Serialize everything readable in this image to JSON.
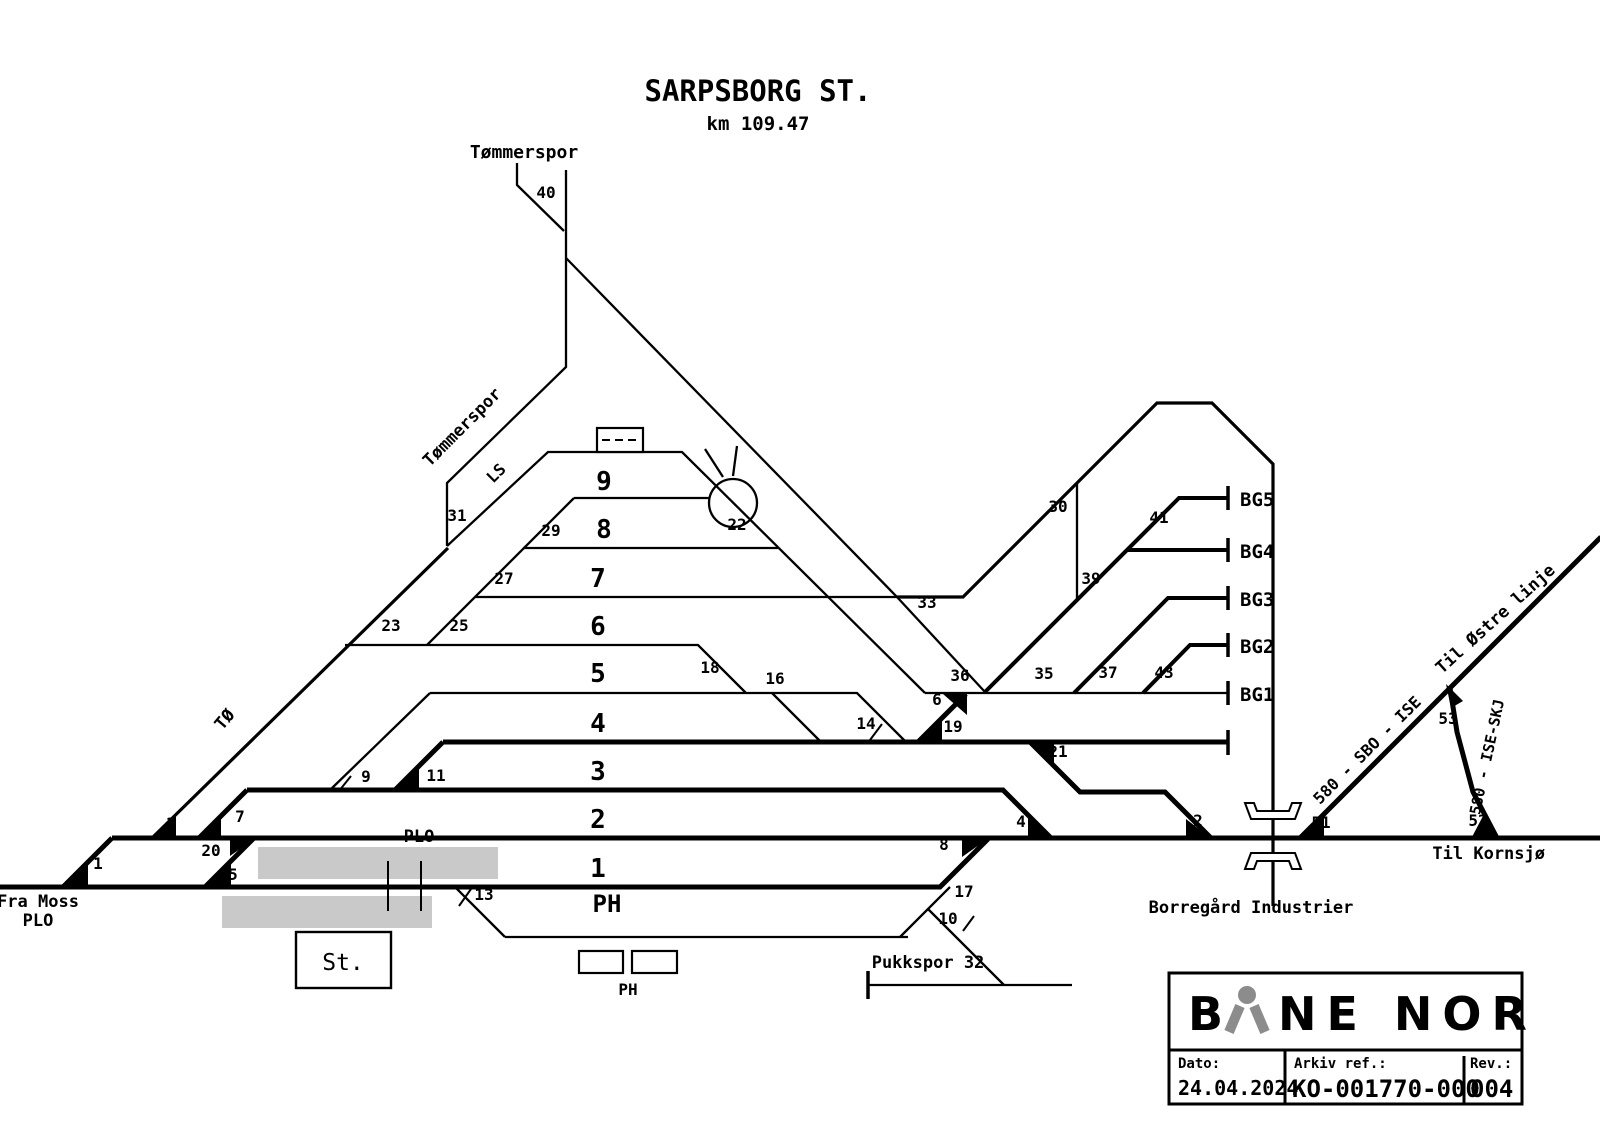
{
  "title": "SARPSBORG ST.",
  "subtitle": "km 109.47",
  "colors": {
    "line": "#000000",
    "platform": "#c9c9c9",
    "logo_gray": "#8c8c8c"
  },
  "title_block": {
    "brand_b": "B",
    "brand_rest": "NE NOR",
    "dato_label": "Dato:",
    "dato_value": "24.04.2024",
    "arkiv_label": "Arkiv ref.:",
    "arkiv_value": "KO-001770-000",
    "rev_label": "Rev.:",
    "rev_value": "004"
  },
  "labels": [
    {
      "n": "station-title",
      "t": "SARPSBORG ST.",
      "x": 758,
      "y": 101,
      "s": 29
    },
    {
      "n": "station-km",
      "t": "km 109.47",
      "x": 758,
      "y": 130,
      "s": 19
    },
    {
      "n": "tommerspor-top-label",
      "t": "Tømmerspor",
      "x": 524,
      "y": 158,
      "s": 18
    },
    {
      "n": "switch-label-40",
      "t": "40",
      "x": 546,
      "y": 198,
      "s": 16
    },
    {
      "n": "tommerspor-rot-label",
      "t": "Tømmerspor",
      "x": 466,
      "y": 431,
      "s": 17,
      "r": -45
    },
    {
      "n": "ls-label",
      "t": "LS",
      "x": 500,
      "y": 477,
      "s": 16,
      "r": -45
    },
    {
      "n": "switch-label-31",
      "t": "31",
      "x": 457,
      "y": 521,
      "s": 16
    },
    {
      "n": "to-label",
      "t": "TØ",
      "x": 229,
      "y": 723,
      "s": 17,
      "r": -50
    },
    {
      "n": "switch-label-23",
      "t": "23",
      "x": 391,
      "y": 631,
      "s": 16
    },
    {
      "n": "switch-label-25",
      "t": "25",
      "x": 459,
      "y": 631,
      "s": 16
    },
    {
      "n": "switch-label-27",
      "t": "27",
      "x": 504,
      "y": 584,
      "s": 16
    },
    {
      "n": "switch-label-29",
      "t": "29",
      "x": 551,
      "y": 536,
      "s": 16
    },
    {
      "n": "switch-label-9",
      "t": "9",
      "x": 366,
      "y": 782,
      "s": 16
    },
    {
      "n": "switch-label-11",
      "t": "11",
      "x": 436,
      "y": 781,
      "s": 16
    },
    {
      "n": "switch-label-1",
      "t": "1",
      "x": 98,
      "y": 869,
      "s": 16
    },
    {
      "n": "switch-label-3",
      "t": "3",
      "x": 171,
      "y": 829,
      "s": 16
    },
    {
      "n": "switch-label-20",
      "t": "20",
      "x": 211,
      "y": 856,
      "s": 16
    },
    {
      "n": "switch-label-7",
      "t": "7",
      "x": 240,
      "y": 822,
      "s": 16
    },
    {
      "n": "switch-label-5",
      "t": "5",
      "x": 233,
      "y": 880,
      "s": 16
    },
    {
      "n": "switch-label-13",
      "t": "13",
      "x": 484,
      "y": 900,
      "s": 16
    },
    {
      "n": "switch-label-22",
      "t": "22",
      "x": 737,
      "y": 530,
      "s": 16
    },
    {
      "n": "switch-label-18",
      "t": "18",
      "x": 710,
      "y": 673,
      "s": 16
    },
    {
      "n": "switch-label-16",
      "t": "16",
      "x": 775,
      "y": 684,
      "s": 16
    },
    {
      "n": "switch-label-14",
      "t": "14",
      "x": 866,
      "y": 729,
      "s": 16
    },
    {
      "n": "switch-label-33",
      "t": "33",
      "x": 927,
      "y": 608,
      "s": 16
    },
    {
      "n": "switch-label-36",
      "t": "36",
      "x": 960,
      "y": 681,
      "s": 16
    },
    {
      "n": "switch-label-6",
      "t": "6",
      "x": 937,
      "y": 705,
      "s": 16
    },
    {
      "n": "switch-label-19",
      "t": "19",
      "x": 953,
      "y": 732,
      "s": 16
    },
    {
      "n": "switch-label-35",
      "t": "35",
      "x": 1044,
      "y": 679,
      "s": 16
    },
    {
      "n": "switch-label-37",
      "t": "37",
      "x": 1108,
      "y": 678,
      "s": 16
    },
    {
      "n": "switch-label-43",
      "t": "43",
      "x": 1164,
      "y": 678,
      "s": 16
    },
    {
      "n": "switch-label-39",
      "t": "39",
      "x": 1091,
      "y": 584,
      "s": 16
    },
    {
      "n": "switch-label-30",
      "t": "30",
      "x": 1058,
      "y": 512,
      "s": 16
    },
    {
      "n": "switch-label-41",
      "t": "41",
      "x": 1159,
      "y": 523,
      "s": 16
    },
    {
      "n": "switch-label-21",
      "t": "21",
      "x": 1058,
      "y": 757,
      "s": 16
    },
    {
      "n": "switch-label-4",
      "t": "4",
      "x": 1021,
      "y": 827,
      "s": 16
    },
    {
      "n": "switch-label-8",
      "t": "8",
      "x": 944,
      "y": 850,
      "s": 16
    },
    {
      "n": "switch-label-2",
      "t": "2",
      "x": 1198,
      "y": 826,
      "s": 16
    },
    {
      "n": "switch-label-17",
      "t": "17",
      "x": 964,
      "y": 897,
      "s": 16
    },
    {
      "n": "switch-label-10",
      "t": "10",
      "x": 948,
      "y": 924,
      "s": 16
    },
    {
      "n": "switch-label-51",
      "t": "51",
      "x": 1321,
      "y": 828,
      "s": 16
    },
    {
      "n": "switch-label-52",
      "t": "52",
      "x": 1478,
      "y": 826,
      "s": 16
    },
    {
      "n": "switch-label-53",
      "t": "53",
      "x": 1448,
      "y": 724,
      "s": 16
    },
    {
      "n": "track-label-9",
      "t": "9",
      "x": 604,
      "y": 490,
      "s": 26
    },
    {
      "n": "track-label-8",
      "t": "8",
      "x": 604,
      "y": 538,
      "s": 26
    },
    {
      "n": "track-label-7",
      "t": "7",
      "x": 598,
      "y": 587,
      "s": 26
    },
    {
      "n": "track-label-6",
      "t": "6",
      "x": 598,
      "y": 635,
      "s": 26
    },
    {
      "n": "track-label-5",
      "t": "5",
      "x": 598,
      "y": 682,
      "s": 26
    },
    {
      "n": "track-label-4",
      "t": "4",
      "x": 598,
      "y": 732,
      "s": 26
    },
    {
      "n": "track-label-3",
      "t": "3",
      "x": 598,
      "y": 780,
      "s": 26
    },
    {
      "n": "track-label-2",
      "t": "2",
      "x": 598,
      "y": 828,
      "s": 26
    },
    {
      "n": "track-label-1",
      "t": "1",
      "x": 598,
      "y": 877,
      "s": 26
    },
    {
      "n": "track-label-ph",
      "t": "PH",
      "x": 607,
      "y": 912,
      "s": 24
    },
    {
      "n": "bg-track-label-1",
      "t": "BG1",
      "x": 1240,
      "y": 701,
      "s": 19,
      "a": "s"
    },
    {
      "n": "bg-track-label-2",
      "t": "BG2",
      "x": 1240,
      "y": 653,
      "s": 19,
      "a": "s"
    },
    {
      "n": "bg-track-label-3",
      "t": "BG3",
      "x": 1240,
      "y": 606,
      "s": 19,
      "a": "s"
    },
    {
      "n": "bg-track-label-4",
      "t": "BG4",
      "x": 1240,
      "y": 558,
      "s": 19,
      "a": "s"
    },
    {
      "n": "bg-track-label-5",
      "t": "BG5",
      "x": 1240,
      "y": 506,
      "s": 19,
      "a": "s"
    },
    {
      "n": "plo-crossing-label",
      "t": "PLO",
      "x": 419,
      "y": 842,
      "s": 17
    },
    {
      "n": "fra-moss-label",
      "t": "Fra Moss",
      "x": 38,
      "y": 907,
      "s": 17
    },
    {
      "n": "fra-moss-plo-label",
      "t": "PLO",
      "x": 38,
      "y": 926,
      "s": 17
    },
    {
      "n": "station-building-label",
      "t": "St.",
      "x": 343,
      "y": 970,
      "s": 23,
      "w": "n"
    },
    {
      "n": "ph-buildings-label",
      "t": "PH",
      "x": 628,
      "y": 995,
      "s": 16
    },
    {
      "n": "pukkspor-label",
      "t": "Pukkspor 32",
      "x": 928,
      "y": 968,
      "s": 17
    },
    {
      "n": "til-kornsjo-label",
      "t": "Til Kornsjø",
      "x": 1545,
      "y": 859,
      "s": 17,
      "a": "e"
    },
    {
      "n": "borregard-label",
      "t": "Borregård Industrier",
      "x": 1251,
      "y": 913,
      "s": 17
    },
    {
      "n": "sbo-ise-label",
      "t": "580 - SBO - ISE",
      "x": 1371,
      "y": 754,
      "s": 16,
      "r": -45
    },
    {
      "n": "ise-skj-label",
      "t": "580 - ISE-SKJ",
      "x": 1492,
      "y": 758,
      "s": 15,
      "r": -78
    },
    {
      "n": "ostre-linje-label",
      "t": "Til Østre linje",
      "x": 1499,
      "y": 623,
      "s": 17,
      "r": -42
    }
  ]
}
